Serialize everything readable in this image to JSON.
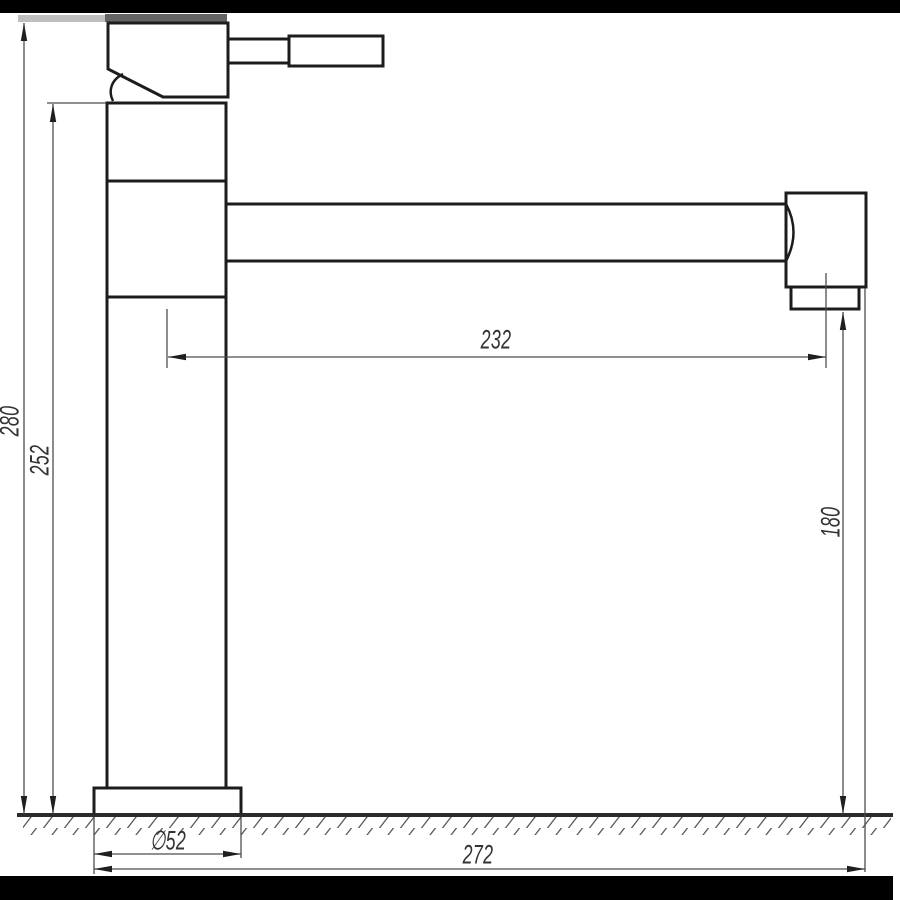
{
  "drawing": {
    "type": "technical-dimension-drawing",
    "dimensions": {
      "overall_height": "280",
      "body_height": "252",
      "spout_reach": "232",
      "spout_outlet_height": "180",
      "base_diameter": "∅52",
      "overall_reach": "272"
    },
    "colors": {
      "object_line": "#1c1c1c",
      "dimension_line": "#4d4d4d",
      "label_text": "#333333",
      "crop_bar": "#000000",
      "hatch_line": "#5a5a5a",
      "background": "#ffffff"
    }
  }
}
